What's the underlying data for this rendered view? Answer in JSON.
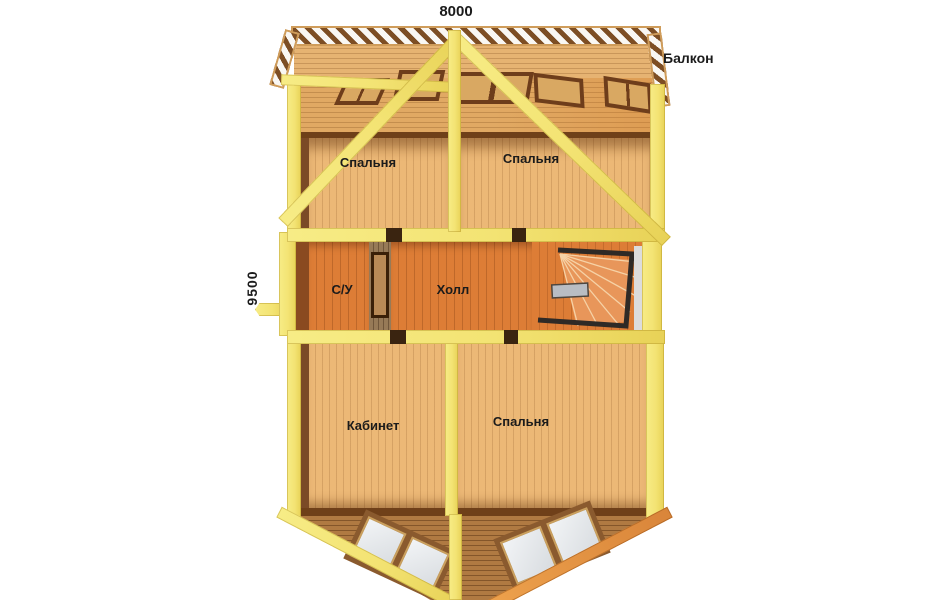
{
  "dimensions": {
    "width": "8000",
    "depth": "9500"
  },
  "labels": {
    "balcony": "Балкон"
  },
  "rooms": [
    {
      "id": "bedroom-top-left",
      "label": "Спальня"
    },
    {
      "id": "bedroom-top-right",
      "label": "Спальня"
    },
    {
      "id": "bathroom",
      "label": "С/У"
    },
    {
      "id": "hall",
      "label": "Холл"
    },
    {
      "id": "study",
      "label": "Кабинет"
    },
    {
      "id": "bedroom-bottom",
      "label": "Спальня"
    }
  ],
  "colors": {
    "background": "#ffffff",
    "beam_yellow": "#f3e373",
    "floor_tan": "#ecb876",
    "floor_orange": "#dd7d36",
    "roof_brown": "#b07a42",
    "frame_dark_brown": "#6e3d1b",
    "railing_brown": "#7d4e24",
    "label_text": "#1b1b1b"
  }
}
